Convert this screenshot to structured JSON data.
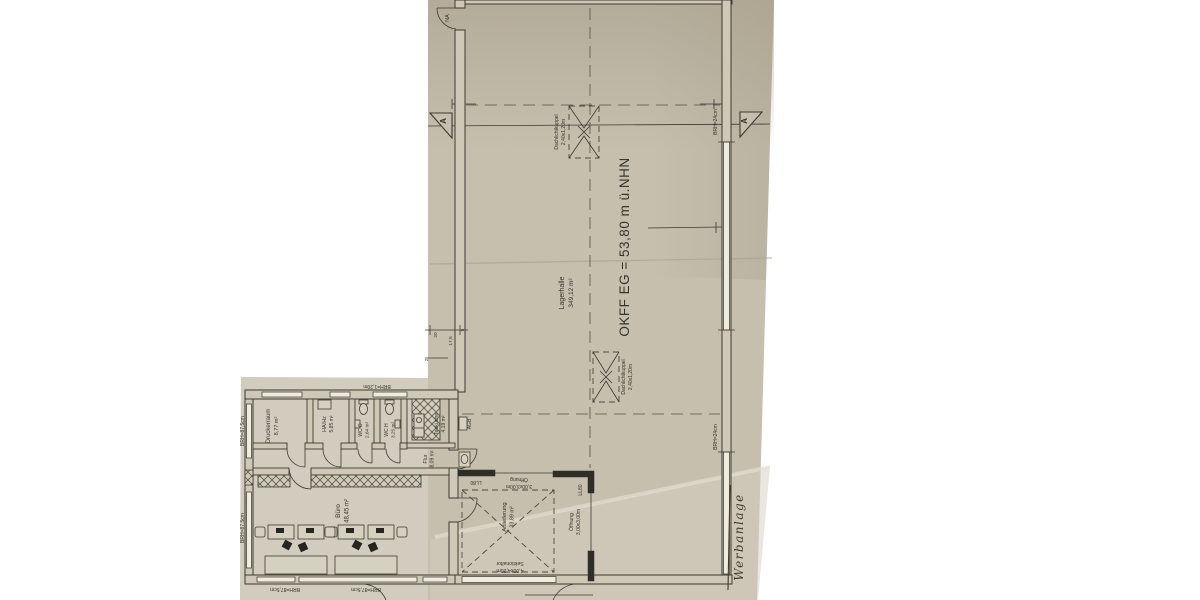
{
  "plan": {
    "hall": {
      "name": "Lagerhalle",
      "area": "349,12 m²",
      "level": "OKFF EG = 53,80 m ü.NHN"
    },
    "rooms": [
      {
        "name": "Druckerraum",
        "area": "8,77 m²"
      },
      {
        "name": "HA/Hz",
        "area": "5,85 m²"
      },
      {
        "name": "WC D",
        "area": "2,64 m²"
      },
      {
        "name": "WC H",
        "area": "3,25 m²"
      },
      {
        "name": "Teeküche",
        "area": "4,19 m²"
      },
      {
        "name": "Flur",
        "area": "8,09 m²"
      },
      {
        "name": "Büro",
        "area": "48,45 m²"
      },
      {
        "name": "Anlieferung",
        "area": "33,89 m²"
      }
    ],
    "skylight": {
      "name": "Dachlichtkuppel",
      "size": "2,40x1,20m"
    },
    "openings": {
      "top": {
        "name": "Öffnung",
        "size": "3,00x3,00m",
        "lintel": "LL80"
      },
      "right": {
        "name": "Öffnung",
        "size": "3,00x3,00m",
        "lintel": "LL80"
      },
      "sectional_door": {
        "name": "Sektionaltor",
        "size": "4,00x4,20m"
      },
      "emergency_exit": "NA",
      "utility_sink": "AGB"
    },
    "sills": {
      "office_left_upper": "BRH=87,5cm",
      "office_left_lower": "BRH=87,5cm",
      "office_bottom_left": "BRH=87,5cm",
      "office_bottom_right": "BRH=87,5cm",
      "office_top": "BRH=1,20m",
      "hall_right_upper": "BRH=24cm",
      "hall_right_lower": "BRH=24cm"
    },
    "section_marker": "A",
    "dims": {
      "a": "5",
      "b": "20",
      "c": "17,5",
      "d": "2"
    },
    "handwriting": "Werbanlage"
  }
}
